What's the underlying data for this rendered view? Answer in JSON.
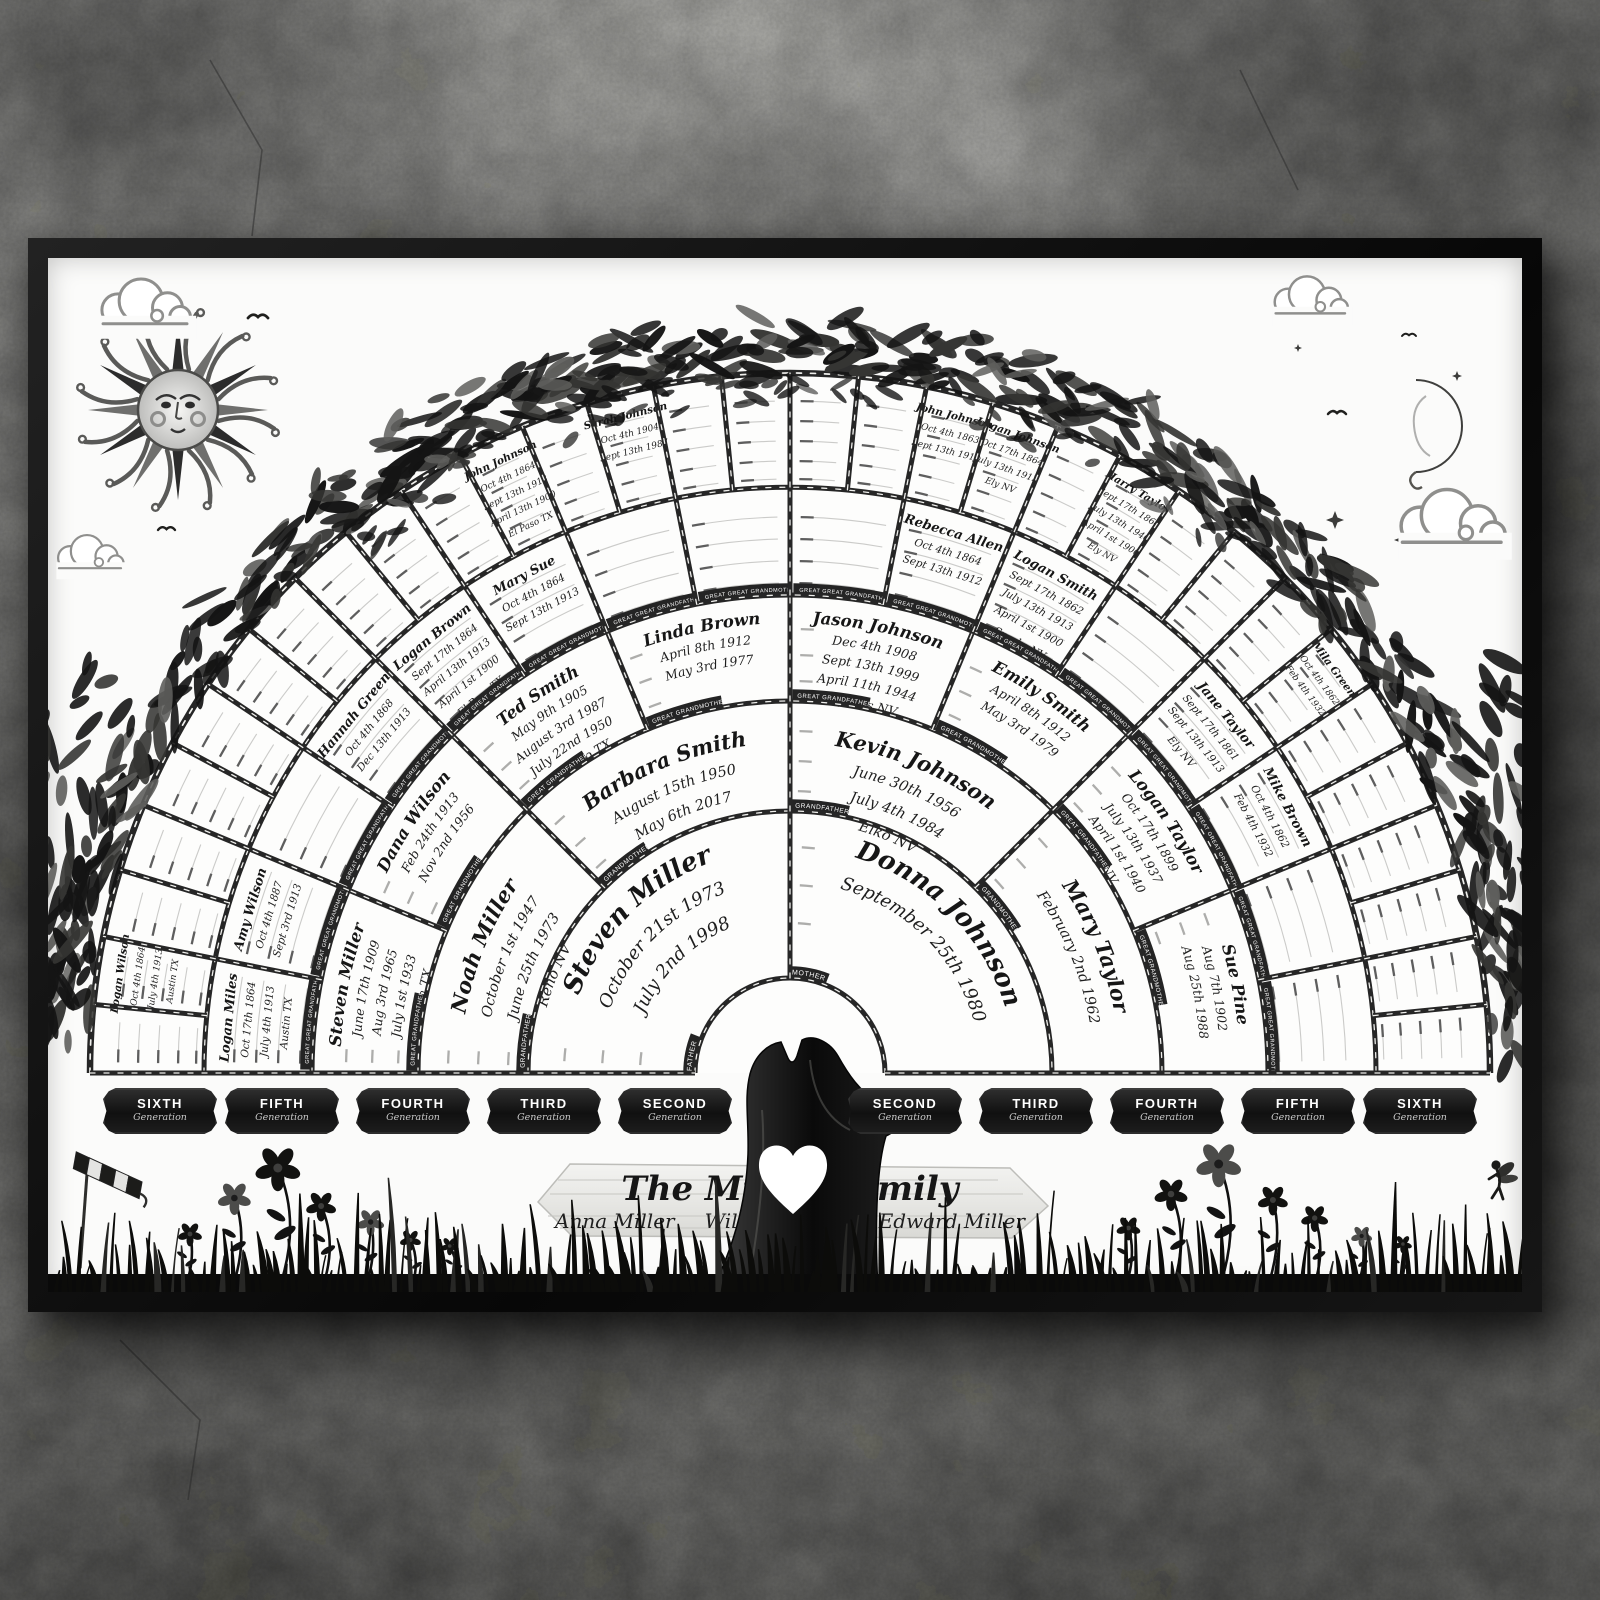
{
  "poster": {
    "title": "The Miller Family",
    "names": [
      "Anna Miller",
      "William Miller",
      "Edward Miller"
    ]
  },
  "plaques": [
    {
      "label": "SIXTH",
      "sub": "Generation"
    },
    {
      "label": "FIFTH",
      "sub": "Generation"
    },
    {
      "label": "FOURTH",
      "sub": "Generation"
    },
    {
      "label": "THIRD",
      "sub": "Generation"
    },
    {
      "label": "SECOND",
      "sub": "Generation"
    },
    {
      "label": "SECOND",
      "sub": "Generation"
    },
    {
      "label": "THIRD",
      "sub": "Generation"
    },
    {
      "label": "FOURTH",
      "sub": "Generation"
    },
    {
      "label": "FIFTH",
      "sub": "Generation"
    },
    {
      "label": "SIXTH",
      "sub": "Generation"
    }
  ],
  "fan": {
    "rings": [
      {
        "generation": "second",
        "cells": [
          {
            "role": "FATHER",
            "name": "Steven Miller",
            "lines": [
              "October 21st 1973",
              "July 2nd 1998"
            ]
          },
          {
            "role": "MOTHER",
            "name": "Donna Johnson",
            "lines": [
              "September 25th 1980"
            ]
          }
        ]
      },
      {
        "generation": "third",
        "cells": [
          {
            "role": "GRANDFATHER",
            "name": "Noah Miller",
            "lines": [
              "October 1st 1947",
              "June 25th 1973",
              "Reno NV"
            ]
          },
          {
            "role": "GRANDMOTHER",
            "name": "Barbara Smith",
            "lines": [
              "August 15th 1950",
              "May 6th 2017"
            ]
          },
          {
            "role": "GRANDFATHER",
            "name": "Kevin Johnson",
            "lines": [
              "June 30th 1956",
              "July 4th 1984",
              "Elko NV"
            ]
          },
          {
            "role": "GRANDMOTHER",
            "name": "Mary Taylor",
            "lines": [
              "February 2nd 1962"
            ]
          }
        ]
      },
      {
        "generation": "fourth",
        "cells": [
          {
            "role": "GREAT GRANDFATHER",
            "name": "Steven Miller",
            "lines": [
              "June 17th 1909",
              "Aug 3rd 1965",
              "July 1st 1933",
              "Austin TX"
            ]
          },
          {
            "role": "GREAT GRANDMOTHER",
            "name": "Dana Wilson",
            "lines": [
              "Feb 24th 1913",
              "Nov 2nd 1956"
            ]
          },
          {
            "role": "GREAT GRANDFATHER",
            "name": "Ted Smith",
            "lines": [
              "May 9th 1905",
              "August 3rd 1987",
              "July 22nd 1950",
              "El Paso TX"
            ]
          },
          {
            "role": "GREAT GRANDMOTHER",
            "name": "Linda Brown",
            "lines": [
              "April 8th 1912",
              "May 3rd 1977"
            ]
          },
          {
            "role": "GREAT GRANDFATHER",
            "name": "Jason Johnson",
            "lines": [
              "Dec 4th 1908",
              "Sept 13th 1999",
              "April 11th 1944",
              "Sparks NV"
            ]
          },
          {
            "role": "GREAT GRANDMOTHER",
            "name": "Emily Smith",
            "lines": [
              "April 8th 1912",
              "May 3rd 1979"
            ]
          },
          {
            "role": "GREAT GRANDFATHER",
            "name": "Logan Taylor",
            "lines": [
              "Oct 17th 1899",
              "July 13th 1937",
              "April 1st 1940",
              "Ely NV"
            ]
          },
          {
            "role": "GREAT GRANDMOTHER",
            "name": "Sue Pine",
            "lines": [
              "Aug 7th 1902",
              "Aug 25th 1988"
            ]
          }
        ]
      },
      {
        "generation": "fifth",
        "cells": [
          {
            "role": "GREAT GREAT GRANDFATHER",
            "name": "Logan Miles",
            "lines": [
              "Oct 17th 1864",
              "July 4th 1913",
              "Austin TX"
            ]
          },
          {
            "role": "GREAT GREAT GRANDMOTHER",
            "name": "Amy Wilson",
            "lines": [
              "Oct 4th 1887",
              "Sept 3rd 1913"
            ]
          },
          {},
          {
            "role": "GREAT GREAT GRANDMOTHER",
            "name": "Hannah Green",
            "lines": [
              "Oct 4th 1868",
              "Dec 13th 1913"
            ]
          },
          {
            "role": "GREAT GREAT GRANDFATHER",
            "name": "Logan Brown",
            "lines": [
              "Sept 17th 1864",
              "April 13th 1913",
              "April 1st 1900",
              "El Paso TX"
            ]
          },
          {
            "role": "GREAT GREAT GRANDMOTHER",
            "name": "Mary Sue",
            "lines": [
              "Oct 4th 1864",
              "Sept 13th 1913"
            ]
          },
          {},
          {},
          {},
          {
            "role": "GREAT GREAT GRANDMOTHER",
            "name": "Rebecca Allen",
            "lines": [
              "Oct 4th 1864",
              "Sept 13th 1912"
            ]
          },
          {
            "role": "GREAT GREAT GRANDFATHER",
            "name": "Logan Smith",
            "lines": [
              "Sept 17th 1862",
              "July 13th 1913",
              "April 1st 1900",
              "Sparks NV"
            ]
          },
          {},
          {
            "role": "GREAT GREAT GRANDMOTHER",
            "name": "Jane Taylor",
            "lines": [
              "Sept 17th 1861",
              "Sept 13th 1913",
              "Ely NV"
            ]
          },
          {
            "role": "GREAT GREAT GRANDFATHER",
            "name": "Mike Brown",
            "lines": [
              "Oct 4th 1862",
              "Feb 4th 1932"
            ]
          },
          {},
          {}
        ]
      },
      {
        "generation": "sixth",
        "cells": [
          {},
          {
            "role": "GREAT GREAT GREAT GRANDFATHER",
            "name": "Logan Wilson",
            "lines": [
              "Oct 4th 1864",
              "July 4th 1913",
              "Austin TX"
            ]
          },
          {},
          {},
          {},
          {},
          {},
          {},
          {},
          {},
          {},
          {
            "role": "GREAT GREAT GREAT GRANDFATHER",
            "name": "John Johnson",
            "lines": [
              "Oct 4th 1864",
              "Sept 13th 1913",
              "April 13th 1900",
              "El Paso TX"
            ]
          },
          {},
          {
            "role": "GREAT GREAT GREAT GRANDMOTHER",
            "name": "Sarah Johnson",
            "lines": [
              "Oct 4th 1904",
              "Sept 13th 1987"
            ]
          },
          {},
          {},
          {},
          {},
          {
            "role": "GREAT GREAT GREAT GRANDFATHER",
            "name": "John Johnson",
            "lines": [
              "Oct 4th 1863",
              "Sept 13th 1912"
            ]
          },
          {
            "role": "GREAT GREAT GREAT GRANDFATHER",
            "name": "Logan Johnson",
            "lines": [
              "Oct 17th 1864",
              "July 13th 1913",
              "Ely NV"
            ]
          },
          {},
          {
            "role": "GREAT GREAT GREAT GRANDFATHER",
            "name": "Harry Taylor",
            "lines": [
              "Sept 17th 1864",
              "July 13th 1940",
              "April 1st 1900",
              "Ely NV"
            ]
          },
          {},
          {},
          {},
          {
            "role": "GREAT GREAT GREAT GRANDMOTHER",
            "name": "Mila Green",
            "lines": [
              "Oct 4th 1862",
              "Feb 4th 1932"
            ]
          },
          {},
          {},
          {},
          {},
          {},
          {}
        ]
      }
    ]
  },
  "colors": {
    "ink": "#1e1e1e",
    "border": "#262626",
    "paper": "#fbfbfa",
    "silhouette": "#121212"
  }
}
